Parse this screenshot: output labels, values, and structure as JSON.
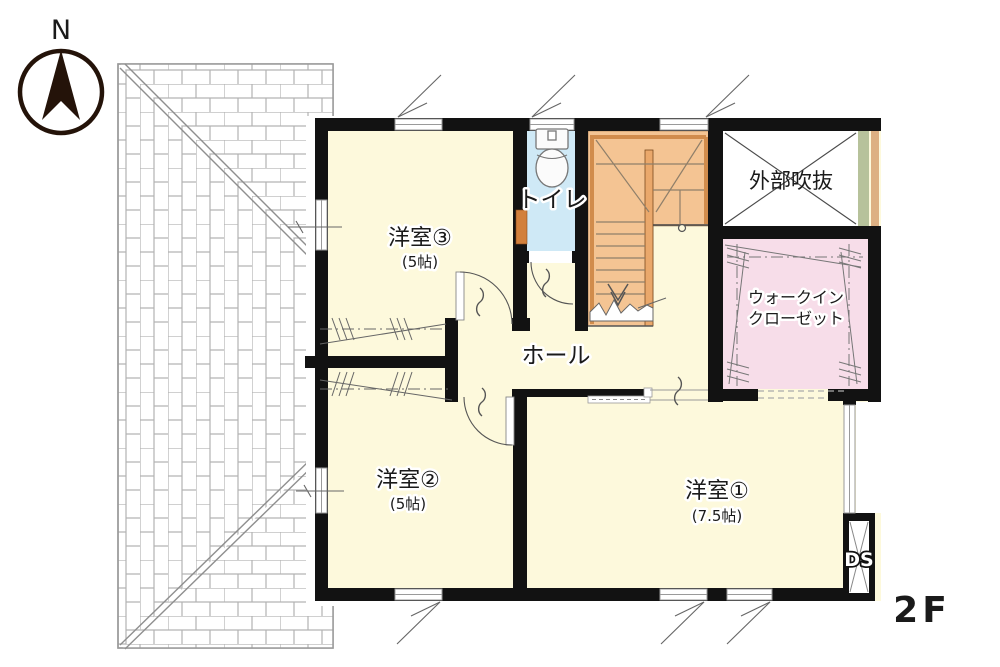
{
  "compass": {
    "label": "N"
  },
  "floor": {
    "label": "2F"
  },
  "rooms": {
    "western3": {
      "name": "洋室③",
      "size": "(5帖)"
    },
    "toilet": {
      "name": "トイレ"
    },
    "exterior_void": {
      "name": "外部吹抜"
    },
    "walk_in_closet": {
      "name_line1": "ウォークイン",
      "name_line2": "クローゼット"
    },
    "hall": {
      "name": "ホール"
    },
    "western2": {
      "name": "洋室②",
      "size": "(5帖)"
    },
    "western1": {
      "name": "洋室①",
      "size": "(7.5帖)"
    },
    "duct_space": {
      "name": "DS"
    }
  },
  "colors": {
    "wall": "#121212",
    "room_floor": "#fdf9dc",
    "toilet_floor": "#cfe9f6",
    "closet_floor": "#f7dde9",
    "stairs_fill": "#f4c493",
    "stairs_trim": "#d18c4c",
    "void_fill": "#ffffff",
    "screen_green": "#b7c29b",
    "screen_tan": "#ddb083",
    "roof_line": "#ababab"
  }
}
